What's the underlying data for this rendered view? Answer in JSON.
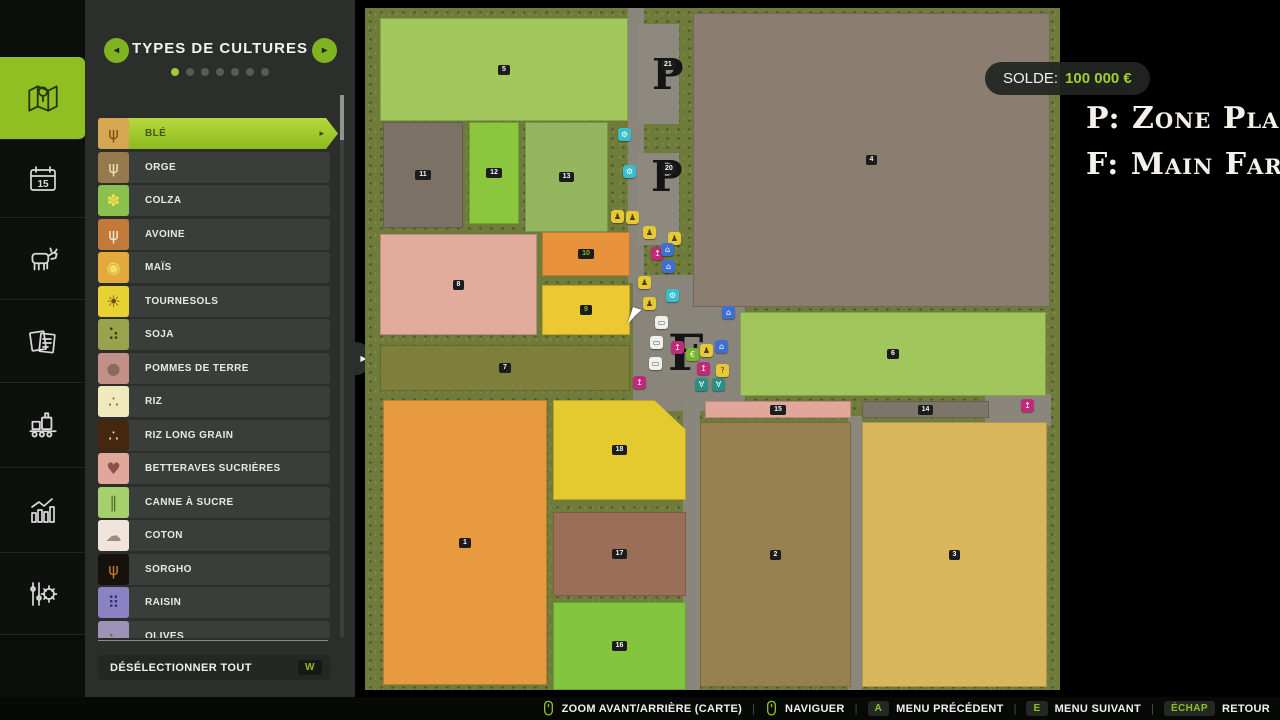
{
  "panel": {
    "title": "TYPES DE CULTURES",
    "dots": {
      "count": 7,
      "active": 0
    },
    "deselect_label": "DÉSÉLECTIONNER TOUT",
    "deselect_key": "W",
    "crops": [
      {
        "label": "BLÉ",
        "icon": "wheat-icon",
        "tile": "#d6a652",
        "glyph": "ψ",
        "glyph_color": "#7a4a16",
        "selected": true
      },
      {
        "label": "ORGE",
        "icon": "barley-icon",
        "tile": "#97794e",
        "glyph": "ψ",
        "glyph_color": "#efe2b0",
        "selected": false
      },
      {
        "label": "COLZA",
        "icon": "canola-icon",
        "tile": "#8bbf4e",
        "glyph": "✽",
        "glyph_color": "#f2df4e",
        "selected": false
      },
      {
        "label": "AVOINE",
        "icon": "oat-icon",
        "tile": "#c27a3a",
        "glyph": "ψ",
        "glyph_color": "#f3ead2",
        "selected": false
      },
      {
        "label": "MAÏS",
        "icon": "corn-icon",
        "tile": "#e3a93c",
        "glyph": "◉",
        "glyph_color": "#f3e06a",
        "selected": false
      },
      {
        "label": "TOURNESOLS",
        "icon": "sunflower-icon",
        "tile": "#e6d233",
        "glyph": "☀",
        "glyph_color": "#6b4a14",
        "selected": false
      },
      {
        "label": "SOJA",
        "icon": "soybean-icon",
        "tile": "#99a24c",
        "glyph": "⠵",
        "glyph_color": "#2f3a14",
        "selected": false
      },
      {
        "label": "POMMES DE TERRE",
        "icon": "potato-icon",
        "tile": "#c29088",
        "glyph": "●",
        "glyph_color": "#8a6a58",
        "selected": false
      },
      {
        "label": "RIZ",
        "icon": "rice-icon",
        "tile": "#efe9bb",
        "glyph": "∴",
        "glyph_color": "#6a6a3a",
        "selected": false
      },
      {
        "label": "RIZ LONG GRAIN",
        "icon": "long-grain-rice-icon",
        "tile": "#45260f",
        "glyph": "∴",
        "glyph_color": "#efe6c8",
        "selected": false
      },
      {
        "label": "BETTERAVES SUCRIÈRES",
        "icon": "sugar-beet-icon",
        "tile": "#e0a89b",
        "glyph": "♥",
        "glyph_color": "#8d4f4a",
        "selected": false
      },
      {
        "label": "CANNE À SUCRE",
        "icon": "sugarcane-icon",
        "tile": "#a6d06e",
        "glyph": "∥",
        "glyph_color": "#3f7026",
        "selected": false
      },
      {
        "label": "COTON",
        "icon": "cotton-icon",
        "tile": "#f1e4db",
        "glyph": "☁",
        "glyph_color": "#9a8c82",
        "selected": false
      },
      {
        "label": "SORGHO",
        "icon": "sorghum-icon",
        "tile": "#17110b",
        "glyph": "ψ",
        "glyph_color": "#c07a38",
        "selected": false
      },
      {
        "label": "RAISIN",
        "icon": "grape-icon",
        "tile": "#8a82c2",
        "glyph": "⠿",
        "glyph_color": "#2f2a66",
        "selected": false
      },
      {
        "label": "OLIVES",
        "icon": "olive-icon",
        "tile": "#9d93b8",
        "glyph": "⠦",
        "glyph_color": "#5a7a2a",
        "selected": false
      }
    ]
  },
  "hud": {
    "balance_label": "SOLDE:",
    "balance_value": "100 000 €"
  },
  "legend": {
    "line1": "P: Zone Pla",
    "line2": "F: Main Far"
  },
  "map": {
    "zones": [
      {
        "name": "road-vertical-north",
        "x": 263,
        "y": 0,
        "w": 16,
        "h": 275,
        "color": "#8a867b"
      },
      {
        "name": "parcel-placeable-21",
        "x": 272,
        "y": 16,
        "w": 42,
        "h": 100,
        "color": "#8e897e"
      },
      {
        "name": "parcel-placeable-20",
        "x": 272,
        "y": 145,
        "w": 42,
        "h": 92,
        "color": "#8e897e"
      },
      {
        "name": "farm-yard",
        "x": 268,
        "y": 267,
        "w": 112,
        "h": 136,
        "color": "#8a857a"
      },
      {
        "name": "road-vertical-mid",
        "x": 318,
        "y": 388,
        "w": 17,
        "h": 294,
        "color": "#8a867b"
      },
      {
        "name": "road-vertical-east",
        "x": 483,
        "y": 408,
        "w": 14,
        "h": 274,
        "color": "#8a867b"
      },
      {
        "name": "road-patch-east",
        "x": 620,
        "y": 386,
        "w": 66,
        "h": 32,
        "color": "#8a867b"
      }
    ],
    "fields": [
      {
        "num": "5",
        "x": 15,
        "y": 10,
        "w": 248,
        "h": 103,
        "color": "#a2c75c",
        "num_green": false
      },
      {
        "num": "11",
        "x": 18,
        "y": 114,
        "w": 80,
        "h": 106,
        "color": "#7b7165",
        "num_green": false
      },
      {
        "num": "12",
        "x": 104,
        "y": 114,
        "w": 50,
        "h": 102,
        "color": "#8cc63f",
        "num_green": false
      },
      {
        "num": "13",
        "x": 160,
        "y": 114,
        "w": 83,
        "h": 110,
        "color": "#93b65e",
        "num_green": false
      },
      {
        "num": "8",
        "x": 15,
        "y": 226,
        "w": 157,
        "h": 101,
        "color": "#e3ab9b",
        "num_green": false
      },
      {
        "num": "10",
        "x": 177,
        "y": 224,
        "w": 88,
        "h": 44,
        "color": "#e8933b",
        "num_green": true
      },
      {
        "num": "9",
        "x": 177,
        "y": 277,
        "w": 88,
        "h": 50,
        "color": "#ecc933",
        "num_green": true
      },
      {
        "num": "7",
        "x": 15,
        "y": 337,
        "w": 250,
        "h": 46,
        "color": "#7d7f3b",
        "num_green": false
      },
      {
        "num": "1",
        "x": 18,
        "y": 392,
        "w": 164,
        "h": 285,
        "color": "#e89a3e",
        "num_green": false
      },
      {
        "num": "18",
        "x": 188,
        "y": 392,
        "w": 133,
        "h": 100,
        "color": "#e5ca2f",
        "num_green": false,
        "cut": true
      },
      {
        "num": "17",
        "x": 188,
        "y": 504,
        "w": 133,
        "h": 84,
        "color": "#9a6e59",
        "num_green": false
      },
      {
        "num": "16",
        "x": 188,
        "y": 594,
        "w": 133,
        "h": 88,
        "color": "#83c53e",
        "num_green": false
      },
      {
        "num": "4",
        "x": 328,
        "y": 5,
        "w": 357,
        "h": 294,
        "color": "#8b7e71",
        "num_green": false
      },
      {
        "num": "6",
        "x": 375,
        "y": 304,
        "w": 306,
        "h": 84,
        "color": "#a1c65c",
        "num_green": false
      },
      {
        "num": "15",
        "x": 340,
        "y": 393,
        "w": 146,
        "h": 17,
        "color": "#e2a79a",
        "num_green": false
      },
      {
        "num": "14",
        "x": 497,
        "y": 393,
        "w": 127,
        "h": 17,
        "color": "#7d746a",
        "num_green": false
      },
      {
        "num": "2",
        "x": 335,
        "y": 414,
        "w": 151,
        "h": 265,
        "color": "#97804f",
        "num_green": false
      },
      {
        "num": "3",
        "x": 497,
        "y": 414,
        "w": 185,
        "h": 265,
        "color": "#d9b65b",
        "num_green": false
      }
    ],
    "letters": [
      {
        "char": "P",
        "x": 287,
        "y": 46,
        "size": 42,
        "badge": "21",
        "bx": 296,
        "by": 52
      },
      {
        "char": "P",
        "x": 286,
        "y": 148,
        "size": 42,
        "badge": "20",
        "bx": 297,
        "by": 156
      },
      {
        "char": "F",
        "x": 303,
        "y": 320,
        "size": 50,
        "badge": "",
        "bx": 0,
        "by": 0
      }
    ],
    "icons": [
      {
        "name": "production-marker",
        "x": 253,
        "y": 120,
        "color": "#38bfcf",
        "glyph": "⚙",
        "gc": "#fff"
      },
      {
        "name": "production-marker",
        "x": 258,
        "y": 157,
        "color": "#38bfcf",
        "glyph": "⚙",
        "gc": "#fff"
      },
      {
        "name": "production-marker",
        "x": 301,
        "y": 281,
        "color": "#38bfcf",
        "glyph": "⚙",
        "gc": "#fff"
      },
      {
        "name": "worker-marker",
        "x": 246,
        "y": 202,
        "color": "#e7c935",
        "glyph": "♟",
        "gc": "#4a3c08"
      },
      {
        "name": "worker-marker",
        "x": 261,
        "y": 203,
        "color": "#e7c935",
        "glyph": "♟",
        "gc": "#4a3c08"
      },
      {
        "name": "worker-marker",
        "x": 278,
        "y": 218,
        "color": "#e7c935",
        "glyph": "♟",
        "gc": "#4a3c08"
      },
      {
        "name": "worker-marker",
        "x": 273,
        "y": 268,
        "color": "#e7c935",
        "glyph": "♟",
        "gc": "#4a3c08"
      },
      {
        "name": "worker-marker",
        "x": 278,
        "y": 289,
        "color": "#e7c935",
        "glyph": "♟",
        "gc": "#4a3c08"
      },
      {
        "name": "worker-marker",
        "x": 303,
        "y": 224,
        "color": "#e7c935",
        "glyph": "♟",
        "gc": "#4a3c08"
      },
      {
        "name": "worker-marker",
        "x": 335,
        "y": 336,
        "color": "#e7c935",
        "glyph": "♟",
        "gc": "#4a3c08"
      },
      {
        "name": "help-marker",
        "x": 351,
        "y": 356,
        "color": "#e7c935",
        "glyph": "?",
        "gc": "#4a3c08"
      },
      {
        "name": "fuel-marker",
        "x": 286,
        "y": 239,
        "color": "#bf2a7a",
        "glyph": "↥",
        "gc": "#fff"
      },
      {
        "name": "fuel-marker",
        "x": 306,
        "y": 333,
        "color": "#bf2a7a",
        "glyph": "↥",
        "gc": "#fff"
      },
      {
        "name": "fuel-marker",
        "x": 332,
        "y": 354,
        "color": "#bf2a7a",
        "glyph": "↥",
        "gc": "#fff"
      },
      {
        "name": "fuel-marker",
        "x": 268,
        "y": 368,
        "color": "#bf2a7a",
        "glyph": "↥",
        "gc": "#fff"
      },
      {
        "name": "fuel-marker",
        "x": 656,
        "y": 391,
        "color": "#bf2a7a",
        "glyph": "↥",
        "gc": "#fff"
      },
      {
        "name": "shop-marker",
        "x": 296,
        "y": 235,
        "color": "#3f6fd0",
        "glyph": "⌂",
        "gc": "#fff"
      },
      {
        "name": "shop-marker",
        "x": 297,
        "y": 252,
        "color": "#3f6fd0",
        "glyph": "⌂",
        "gc": "#fff"
      },
      {
        "name": "shop-marker",
        "x": 357,
        "y": 298,
        "color": "#3f6fd0",
        "glyph": "⌂",
        "gc": "#fff"
      },
      {
        "name": "shop-marker",
        "x": 350,
        "y": 332,
        "color": "#3f6fd0",
        "glyph": "⌂",
        "gc": "#fff"
      },
      {
        "name": "animal-marker",
        "x": 330,
        "y": 370,
        "color": "#2a8f86",
        "glyph": "∀",
        "gc": "#fff"
      },
      {
        "name": "animal-marker",
        "x": 347,
        "y": 370,
        "color": "#2a8f86",
        "glyph": "∀",
        "gc": "#fff"
      },
      {
        "name": "sale-marker",
        "x": 321,
        "y": 340,
        "color": "#7ab52f",
        "glyph": "€",
        "gc": "#fff"
      },
      {
        "name": "vehicle-marker",
        "x": 290,
        "y": 308,
        "color": "#f0f0ec",
        "glyph": "▭",
        "gc": "#555"
      },
      {
        "name": "vehicle-marker",
        "x": 285,
        "y": 328,
        "color": "#f0f0ec",
        "glyph": "▭",
        "gc": "#555"
      },
      {
        "name": "vehicle-marker",
        "x": 284,
        "y": 349,
        "color": "#f0f0ec",
        "glyph": "▭",
        "gc": "#555"
      }
    ],
    "cursor": {
      "x": 265,
      "y": 300
    }
  },
  "bottom_bar": {
    "items": [
      {
        "icon": "mouse-scroll-icon",
        "key": "",
        "label": "ZOOM AVANT/ARRIÈRE (CARTE)"
      },
      {
        "icon": "mouse-move-icon",
        "key": "",
        "label": "NAVIGUER"
      },
      {
        "icon": "",
        "key": "A",
        "label": "MENU PRÉCÉDENT"
      },
      {
        "icon": "",
        "key": "E",
        "label": "MENU SUIVANT"
      },
      {
        "icon": "",
        "key": "ÉCHAP",
        "label": "RETOUR"
      }
    ]
  }
}
